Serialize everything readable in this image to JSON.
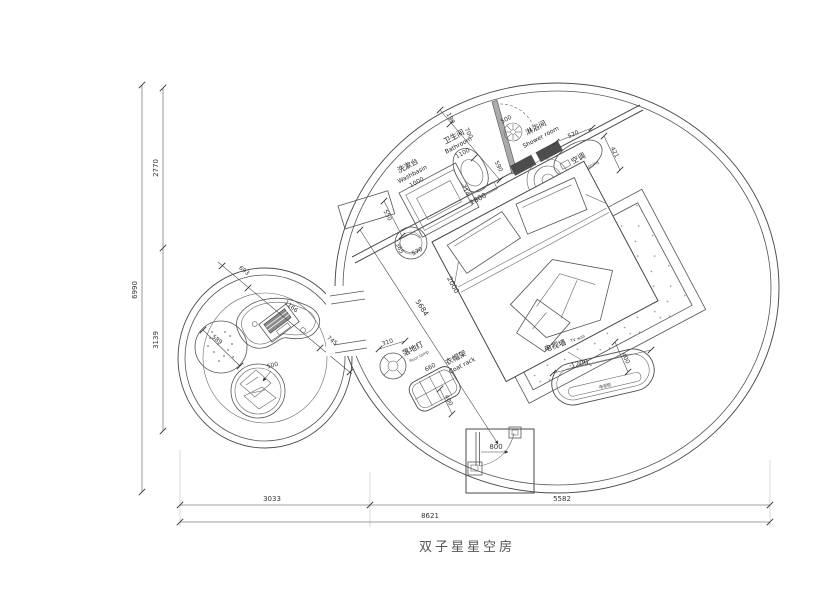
{
  "title": "双子星星空房",
  "fixtures": {
    "washbasin": {
      "zh": "洗漱台",
      "en": "Washbasin",
      "size": "1000"
    },
    "bathroom": {
      "zh": "卫生间",
      "en": "Bathroom",
      "size": "1100"
    },
    "shower": {
      "zh": "淋浴间",
      "en": "Shower room"
    },
    "ac": {
      "zh": "空调",
      "en": "air-conditioning"
    },
    "floor_lamp": {
      "zh": "落地灯",
      "en": "floor lamp"
    },
    "coat_rack": {
      "zh": "衣帽架",
      "en": "Coat rack"
    },
    "tv_wall": {
      "zh": "电视墙",
      "en": "TV wall"
    },
    "tv_cabinet": {
      "zh": "电视柜"
    }
  },
  "dims": {
    "v_total": "6990",
    "v_upper": "2770",
    "v_lower": "3139",
    "h_left": "3033",
    "h_right": "5582",
    "h_total": "8621",
    "diag": "5684",
    "bed_len": "2000",
    "bed_wid": "1800",
    "wall_714": "714",
    "counter_550": "550",
    "stool_365": "365",
    "stool_570": "570",
    "bath_190": "190",
    "bath_700": "700",
    "bath_590": "590",
    "shower_door_500": "500",
    "ac_520": "520",
    "ac_421": "421",
    "lamp_310": "310",
    "coat_660": "660",
    "coat_400": "400",
    "tv_1200": "1200",
    "tv_400": "400",
    "door_800": "800",
    "lounge_693": "693",
    "lounge_1166": "1166",
    "lounge_745": "745",
    "lounge_589": "589",
    "lounge_500": "500"
  },
  "colors": {
    "line": "#4a4a4a",
    "dim_text": "#333333",
    "dark_fill": "#4d4d4d"
  }
}
